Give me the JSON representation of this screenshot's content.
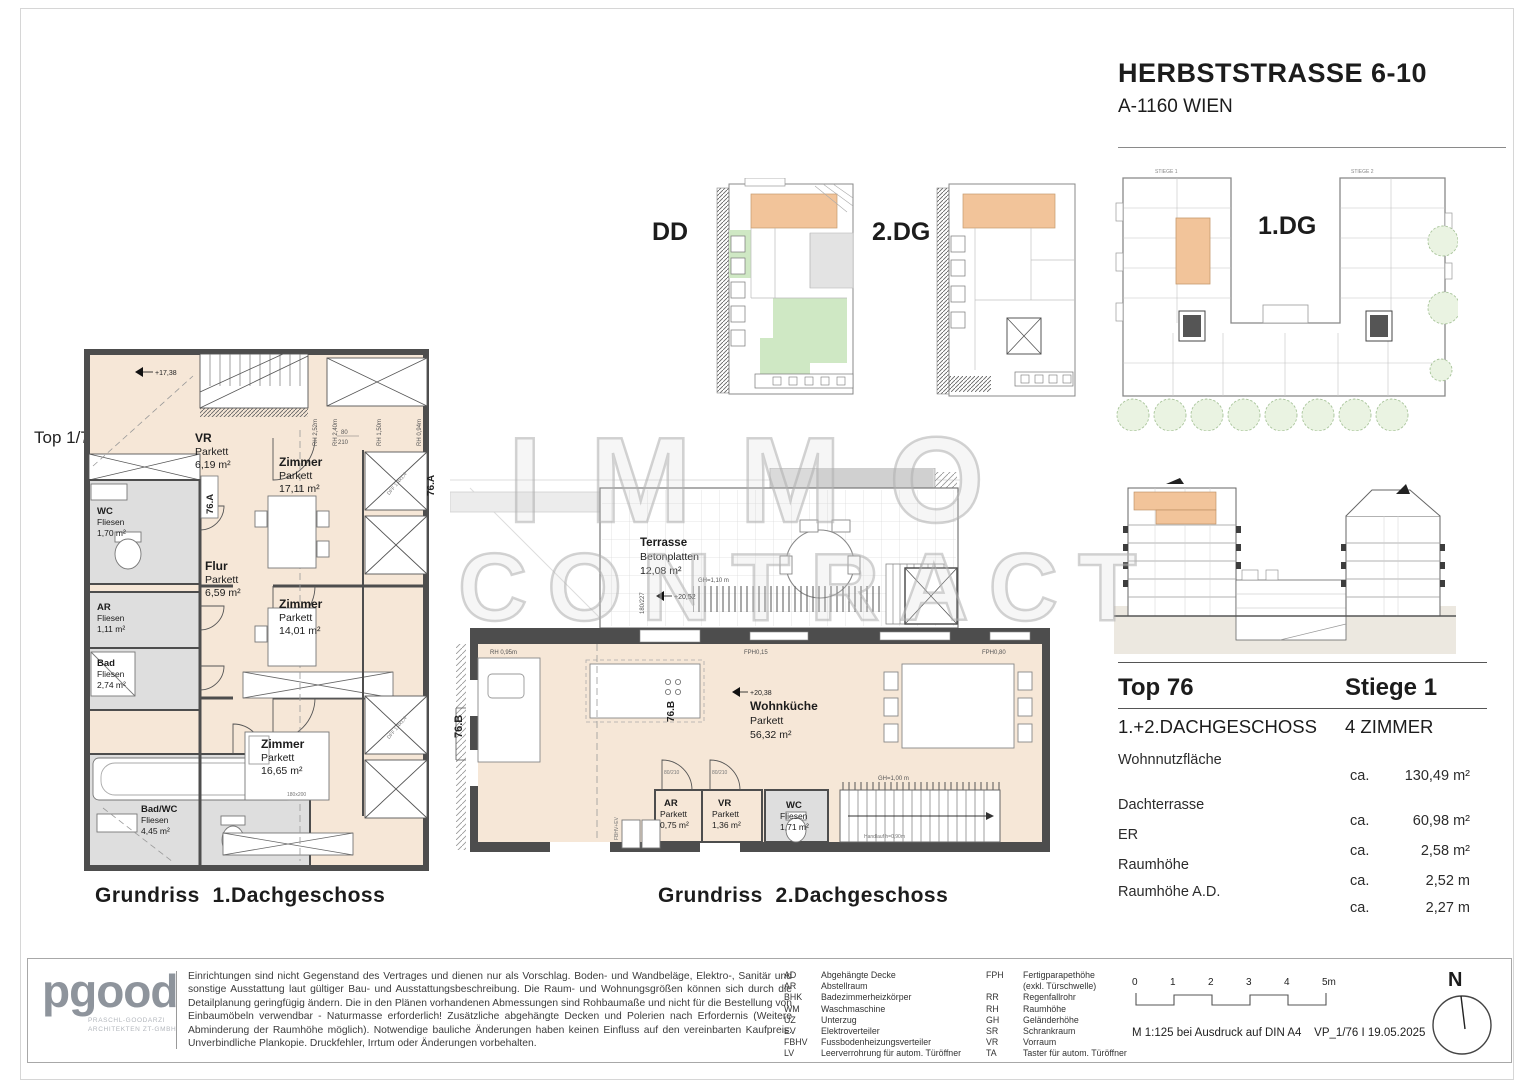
{
  "header": {
    "title": "HERBSTSTRASSE 6-10",
    "subtitle": "A-1160 WIEN"
  },
  "watermark": {
    "line1": "IMMO",
    "line2": "CONTRACT"
  },
  "key_plans": {
    "dd": "DD",
    "dg2": "2.DG",
    "dg1": "1.DG",
    "stiege1": "STIEGE 1",
    "stiege2": "STIEGE 2"
  },
  "plan1": {
    "caption": "Grundriss  1.Dachgeschoss",
    "arrow_label": "Top 1/76",
    "unit": "76.A",
    "level": "+17,38",
    "door_w": "80",
    "door_h": "210",
    "bed_size": "180x200",
    "skylight": "DFF 1,4x1,4",
    "dims": {
      "rh1": "RH 2,52m",
      "rh2": "RH 2,40m",
      "rh3": "RH 1,50m",
      "rh4": "RH 0,94m"
    },
    "rooms": {
      "vr": {
        "name": "VR",
        "floor": "Parkett",
        "area": "6,19 m²"
      },
      "zimmer1": {
        "name": "Zimmer",
        "floor": "Parkett",
        "area": "17,11 m²"
      },
      "wc": {
        "name": "WC",
        "floor": "Fliesen",
        "area": "1,70 m²"
      },
      "flur": {
        "name": "Flur",
        "floor": "Parkett",
        "area": "6,59 m²"
      },
      "zimmer2": {
        "name": "Zimmer",
        "floor": "Parkett",
        "area": "14,01 m²"
      },
      "ar": {
        "name": "AR",
        "floor": "Fliesen",
        "area": "1,11 m²"
      },
      "bad": {
        "name": "Bad",
        "floor": "Fliesen",
        "area": "2,74 m²"
      },
      "zimmer3": {
        "name": "Zimmer",
        "floor": "Parkett",
        "area": "16,65 m²"
      },
      "badwc": {
        "name": "Bad/WC",
        "floor": "Fliesen",
        "area": "4,45 m²"
      }
    }
  },
  "plan2": {
    "caption": "Grundriss  2.Dachgeschoss",
    "unit": "76.B",
    "level": "+20,38",
    "terrace_level": "+20,52",
    "fph_door": "FPH0,15",
    "fph_window": "FPH0,80",
    "rh_wall": "RH 0,95m",
    "rail_gh": "GH=1,10 m",
    "stair_gh": "GH=1,00 m",
    "handrail": "Handlauf h=0,90m",
    "door_dim": "180/227",
    "shaft_label": "FBHV+EV",
    "door_dim_small": "80/210",
    "rooms": {
      "terrasse": {
        "name": "Terrasse",
        "floor": "Betonplatten",
        "area": "12,08 m²"
      },
      "wohnkueche": {
        "name": "Wohnküche",
        "floor": "Parkett",
        "area": "56,32 m²"
      },
      "ar": {
        "name": "AR",
        "floor": "Parkett",
        "area": "0,75 m²"
      },
      "vr": {
        "name": "VR",
        "floor": "Parkett",
        "area": "1,36 m²"
      },
      "wc": {
        "name": "WC",
        "floor": "Fliesen",
        "area": "1,71 m²"
      }
    }
  },
  "info": {
    "top": "Top 76",
    "stiege": "Stiege 1",
    "floor_line": "1.+2.DACHGESCHOSS",
    "zimmer_line": "4 ZIMMER",
    "rows": [
      {
        "label": "Wohnnutzfläche",
        "prefix": "ca.",
        "num": "130,49 m²"
      },
      {
        "label": "Dachterrasse",
        "prefix": "ca.",
        "num": "60,98 m²"
      },
      {
        "label": "ER",
        "prefix": "ca.",
        "num": "2,58 m²"
      },
      {
        "label": "Raumhöhe",
        "prefix": "ca.",
        "num": "2,52 m"
      },
      {
        "label": "Raumhöhe A.D.",
        "prefix": "ca.",
        "num": "2,27 m"
      }
    ]
  },
  "footer": {
    "logo": {
      "text": "pgood",
      "sub1": "PRASCHL-GOODARZI",
      "sub2": "ARCHITEKTEN ZT-GMBH"
    },
    "disclaimer": "Einrichtungen sind nicht Gegenstand des Vertrages und dienen nur als Vorschlag. Boden- und Wandbeläge, Elektro-, Sanitär und sonstige Ausstattung laut gültiger Bau- und Ausstattungsbeschreibung. Die Raum- und Wohnungsgrößen können sich durch die Detailplanung geringfügig ändern. Die in den Plänen vorhandenen Abmessungen sind Rohbaumaße und nicht für die Bestellung von Einbaumöbeln verwendbar - Naturmasse erforderlich! Zusätzliche abgehängte Decken und Polerien nach Erfordernis (Weitere Abminderung der Raumhöhe möglich). Notwendige bauliche Änderungen haben keinen Einfluss auf den vereinbarten Kaufpreis. Unverbindliche Plankopie. Druckfehler, Irrtum oder Änderungen vorbehalten.",
    "legend1": [
      {
        "abbr": "AD",
        "text": "Abgehängte Decke"
      },
      {
        "abbr": "AR",
        "text": "Abstellraum"
      },
      {
        "abbr": "BHK",
        "text": "Badezimmerheizkörper"
      },
      {
        "abbr": "WM",
        "text": "Waschmaschine"
      },
      {
        "abbr": "UZ",
        "text": "Unterzug"
      },
      {
        "abbr": "EV",
        "text": "Elektroverteiler"
      },
      {
        "abbr": "FBHV",
        "text": "Fussbodenheizungsverteiler"
      },
      {
        "abbr": "LV",
        "text": "Leerverrohrung für autom. Türöffner"
      }
    ],
    "legend2": [
      {
        "abbr": "FPH",
        "text": "Fertigparapethöhe"
      },
      {
        "abbr": "",
        "text": "(exkl. Türschwelle)"
      },
      {
        "abbr": "RR",
        "text": "Regenfallrohr"
      },
      {
        "abbr": "RH",
        "text": "Raumhöhe"
      },
      {
        "abbr": "GH",
        "text": "Geländerhöhe"
      },
      {
        "abbr": "SR",
        "text": "Schrankraum"
      },
      {
        "abbr": "VR",
        "text": "Vorraum"
      },
      {
        "abbr": "TA",
        "text": "Taster für autom. Türöffner"
      }
    ],
    "scale": {
      "t0": "0",
      "t1": "1",
      "t2": "2",
      "t3": "3",
      "t4": "4",
      "t5": "5m",
      "note": "M 1:125 bei Ausdruck auf DIN A4    VP_1/76 I 19.05.2025"
    },
    "north": "N"
  },
  "colors": {
    "highlight_orange": "#f2c49a",
    "room_cream": "#f6e7d7",
    "green": "#cfe8c4",
    "wall": "#4d4d4d"
  }
}
